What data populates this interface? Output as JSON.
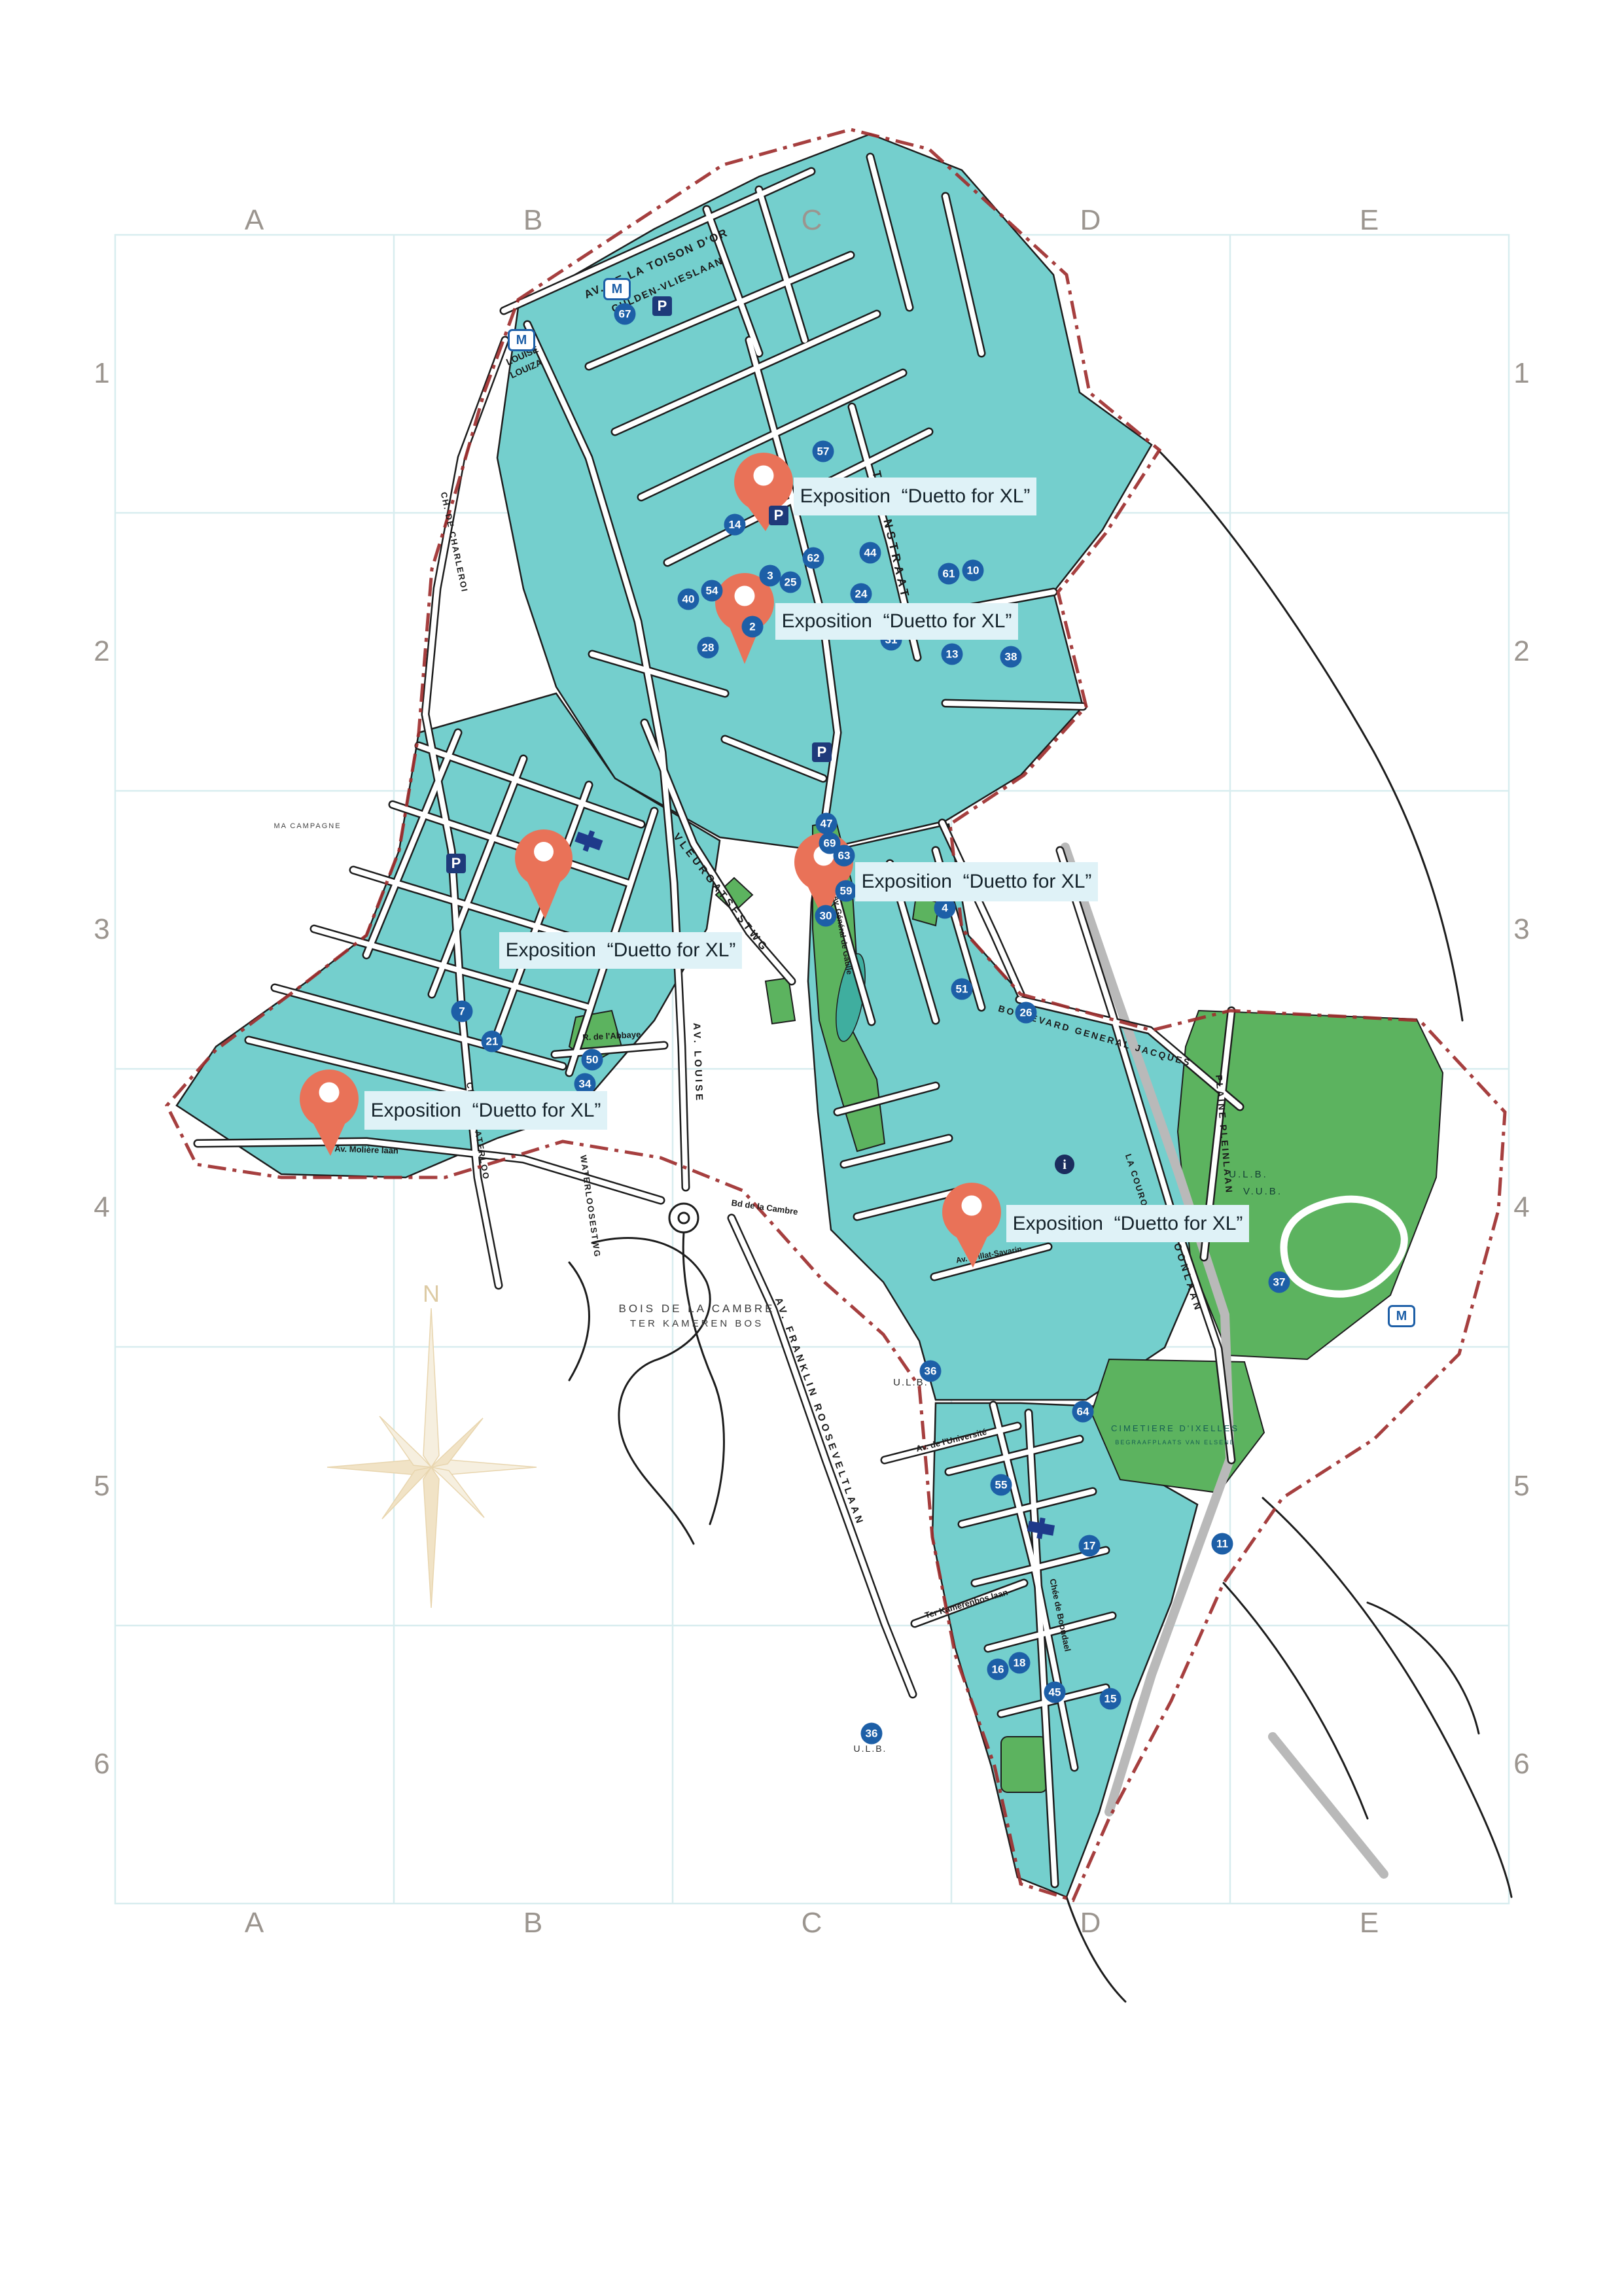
{
  "map_title": "Ixelles exposition map",
  "grid": {
    "column_labels": [
      "A",
      "B",
      "C",
      "D",
      "E"
    ],
    "row_labels": [
      "1",
      "2",
      "3",
      "4",
      "5",
      "6"
    ],
    "line_color": "#d8edef",
    "label_color": "#9b958f"
  },
  "pin": {
    "label": "Exposition  “Duetto for XL”",
    "color": "#e97258",
    "label_bg": "#dff2f7"
  },
  "compass": {
    "north": "N",
    "color": "#e8d5ae"
  },
  "icons": {
    "metro": "M",
    "parking": "P",
    "info": "i"
  },
  "colors": {
    "block": "#74cfcd",
    "park": "#5cb35f",
    "pond": "#3fae9f",
    "marker": "#1d5fa7",
    "boundary": "#9e2f2f",
    "railway": "#b9b9b9"
  },
  "streets": [
    {
      "name": "AV. DE LA TOISON D'OR"
    },
    {
      "name": "GULDEN-VLIESLAAN"
    },
    {
      "name": "LOUISE"
    },
    {
      "name": "LOUIZA"
    },
    {
      "name": "TROONSTRAAT"
    },
    {
      "name": "VLEURGATSESTWG"
    },
    {
      "name": "AV. LOUISE"
    },
    {
      "name": "CH. DE CHARLEROI"
    },
    {
      "name": "WATERLOOSESTWG"
    },
    {
      "name": "CH. DE WATERLOO"
    },
    {
      "name": "Av. Molière laan"
    },
    {
      "name": "R. de l'Abbaye"
    },
    {
      "name": "BOULEVARD GENERAL JACQUES"
    },
    {
      "name": "KROONLAAN"
    },
    {
      "name": "LA COURONNE"
    },
    {
      "name": "PLAINE PLEINLAAN"
    },
    {
      "name": "AV. FRANKLIN ROOSEVELTLAAN"
    },
    {
      "name": "Bd de la Cambre"
    },
    {
      "name": "Av. Général de Gaulle"
    },
    {
      "name": "Chée de Boondael"
    },
    {
      "name": "Av. de l'Université"
    },
    {
      "name": "Ter Kamerenbos laan"
    },
    {
      "name": "Av. Brillat-Savarin"
    }
  ],
  "places": {
    "bois_fr": "BOIS DE LA CAMBRE",
    "bois_nl": "TER KAMEREN BOS",
    "ulb": "U.L.B.",
    "vub": "V.U.B.",
    "ulb2": "U.L.B.",
    "cemetery_fr": "CIMETIERE D'IXELLES",
    "cemetery_nl": "BEGRAAFPLAATS VAN ELSENE",
    "ma_campagne": "MA CAMPAGNE"
  },
  "markers": [
    {
      "n": "67"
    },
    {
      "n": "57"
    },
    {
      "n": "14"
    },
    {
      "n": "54"
    },
    {
      "n": "40"
    },
    {
      "n": "3"
    },
    {
      "n": "25"
    },
    {
      "n": "2"
    },
    {
      "n": "62"
    },
    {
      "n": "24"
    },
    {
      "n": "44"
    },
    {
      "n": "28"
    },
    {
      "n": "31"
    },
    {
      "n": "10"
    },
    {
      "n": "61"
    },
    {
      "n": "38"
    },
    {
      "n": "13"
    },
    {
      "n": "47"
    },
    {
      "n": "69"
    },
    {
      "n": "63"
    },
    {
      "n": "59"
    },
    {
      "n": "30"
    },
    {
      "n": "4"
    },
    {
      "n": "7"
    },
    {
      "n": "21"
    },
    {
      "n": "50"
    },
    {
      "n": "34"
    },
    {
      "n": "51"
    },
    {
      "n": "26"
    },
    {
      "n": "37"
    },
    {
      "n": "36"
    },
    {
      "n": "55"
    },
    {
      "n": "17"
    },
    {
      "n": "16"
    },
    {
      "n": "18"
    },
    {
      "n": "45"
    },
    {
      "n": "64"
    },
    {
      "n": "36"
    },
    {
      "n": "11"
    },
    {
      "n": "15"
    }
  ]
}
